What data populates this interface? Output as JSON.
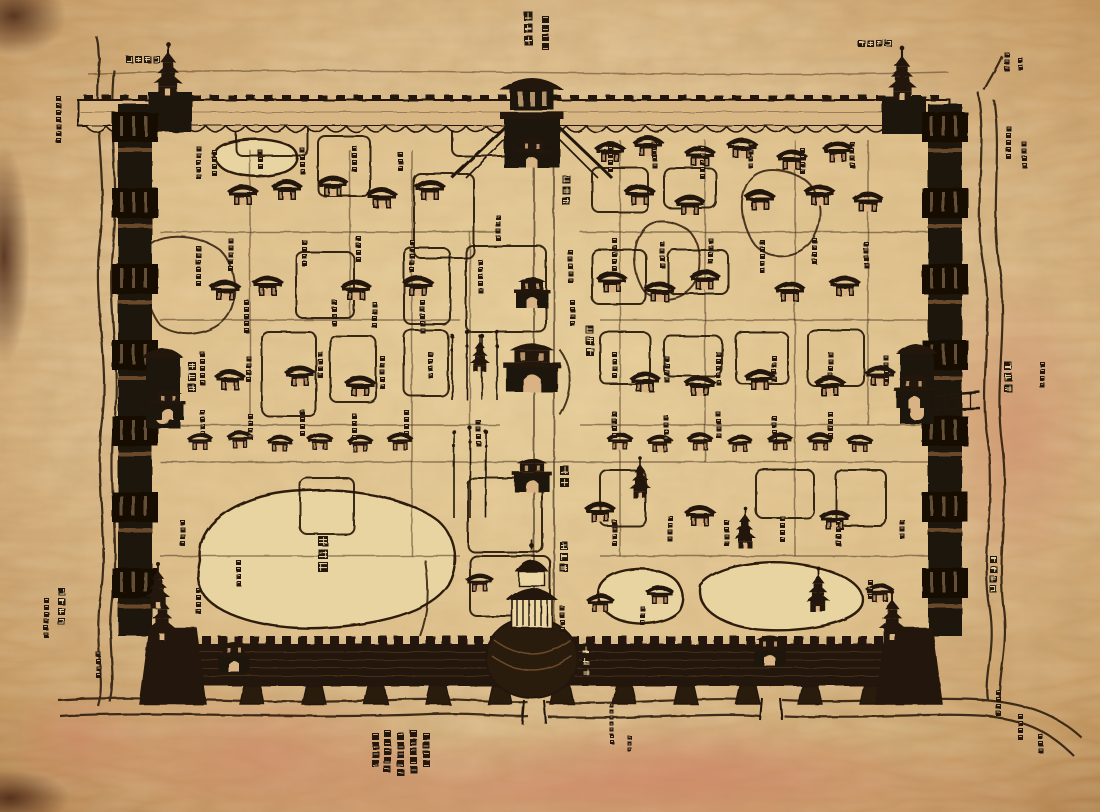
{
  "document": {
    "type": "antique Chinese walled-city map (woodblock style)",
    "script_note": "dense Chinese character labels, largely illegible at this resolution"
  },
  "palette": {
    "ink": "#241607",
    "wall_dark": "#1d1208",
    "paper": "#d9b383",
    "paper_light": "#ecd6a4",
    "ground": "#e3c791",
    "lake": "#e8d4a0",
    "stain_pink": "#cd8264",
    "hatch": "#6b4a2a"
  },
  "labels": [
    {
      "name": "north-gate-label",
      "text": "北安門",
      "x": 524,
      "y": 12,
      "dir": "v",
      "size": 9
    },
    {
      "name": "nw-corner-label",
      "text": "西北角樓",
      "x": 126,
      "y": 56,
      "dir": "h",
      "size": 7
    },
    {
      "name": "ne-corner-label",
      "text": "東北角樓",
      "x": 858,
      "y": 40,
      "dir": "h",
      "size": 7
    },
    {
      "name": "inner-north-gate-label",
      "text": "玄武門",
      "x": 562,
      "y": 175,
      "dir": "v",
      "size": 8
    },
    {
      "name": "central-hill-label",
      "text": "萬歲山",
      "x": 586,
      "y": 326,
      "dir": "v",
      "size": 8
    },
    {
      "name": "meridian-gate-label",
      "text": "午門",
      "x": 560,
      "y": 466,
      "dir": "v",
      "size": 9
    },
    {
      "name": "south-axis-gate-label",
      "text": "大明門",
      "x": 560,
      "y": 542,
      "dir": "v",
      "size": 8
    },
    {
      "name": "south-gate-label",
      "text": "正陽門",
      "x": 582,
      "y": 646,
      "dir": "v",
      "size": 8
    },
    {
      "name": "west-gate-label",
      "text": "西安門",
      "x": 188,
      "y": 362,
      "dir": "v",
      "size": 8
    },
    {
      "name": "east-gate-label",
      "text": "東安門",
      "x": 1004,
      "y": 362,
      "dir": "v",
      "size": 8
    },
    {
      "name": "west-lake-label",
      "text": "太液池",
      "x": 318,
      "y": 536,
      "dir": "v",
      "size": 10
    },
    {
      "name": "sw-corner-label",
      "text": "西南角樓",
      "x": 58,
      "y": 588,
      "dir": "v",
      "size": 7
    },
    {
      "name": "se-corner-label",
      "text": "東南角樓",
      "x": 990,
      "y": 556,
      "dir": "v",
      "size": 7
    }
  ],
  "annotation_blocks": [
    [
      56,
      96,
      7,
      5
    ],
    [
      44,
      598,
      6,
      5
    ],
    [
      96,
      652,
      4,
      5
    ],
    [
      1006,
      126,
      5,
      5
    ],
    [
      1022,
      142,
      4,
      5
    ],
    [
      1040,
      362,
      4,
      5
    ],
    [
      996,
      690,
      4,
      5
    ],
    [
      1018,
      714,
      4,
      5
    ],
    [
      1038,
      734,
      3,
      5
    ],
    [
      1004,
      52,
      3,
      5
    ],
    [
      1018,
      58,
      2,
      5
    ],
    [
      542,
      16,
      4,
      7
    ],
    [
      372,
      733,
      4,
      7
    ],
    [
      384,
      730,
      5,
      7
    ],
    [
      397,
      733,
      5,
      7
    ],
    [
      410,
      730,
      5,
      7
    ],
    [
      423,
      733,
      4,
      7
    ],
    [
      610,
      704,
      7,
      4
    ],
    [
      628,
      736,
      3,
      4
    ],
    [
      196,
      146,
      5,
      5
    ],
    [
      212,
      150,
      4,
      5
    ],
    [
      258,
      150,
      3,
      5
    ],
    [
      300,
      148,
      4,
      5
    ],
    [
      352,
      146,
      4,
      5
    ],
    [
      398,
      152,
      3,
      5
    ],
    [
      228,
      238,
      5,
      5
    ],
    [
      196,
      246,
      6,
      5
    ],
    [
      302,
      240,
      4,
      5
    ],
    [
      356,
      236,
      4,
      5
    ],
    [
      410,
      240,
      5,
      5
    ],
    [
      244,
      300,
      5,
      5
    ],
    [
      332,
      300,
      4,
      5
    ],
    [
      372,
      302,
      4,
      5
    ],
    [
      420,
      300,
      5,
      5
    ],
    [
      200,
      352,
      5,
      5
    ],
    [
      246,
      356,
      4,
      5
    ],
    [
      318,
      352,
      4,
      5
    ],
    [
      380,
      356,
      5,
      5
    ],
    [
      428,
      352,
      4,
      5
    ],
    [
      200,
      410,
      4,
      5
    ],
    [
      248,
      414,
      4,
      5
    ],
    [
      300,
      410,
      4,
      5
    ],
    [
      352,
      414,
      4,
      5
    ],
    [
      404,
      410,
      4,
      5
    ],
    [
      608,
      146,
      4,
      5
    ],
    [
      652,
      142,
      4,
      5
    ],
    [
      700,
      146,
      5,
      5
    ],
    [
      748,
      142,
      4,
      5
    ],
    [
      800,
      148,
      4,
      5
    ],
    [
      850,
      142,
      4,
      5
    ],
    [
      612,
      238,
      5,
      5
    ],
    [
      660,
      242,
      4,
      5
    ],
    [
      708,
      238,
      4,
      5
    ],
    [
      760,
      240,
      5,
      5
    ],
    [
      812,
      238,
      4,
      5
    ],
    [
      864,
      242,
      4,
      5
    ],
    [
      612,
      352,
      4,
      5
    ],
    [
      664,
      356,
      4,
      5
    ],
    [
      716,
      352,
      5,
      5
    ],
    [
      772,
      356,
      4,
      5
    ],
    [
      828,
      352,
      4,
      5
    ],
    [
      884,
      356,
      4,
      5
    ],
    [
      612,
      412,
      4,
      5
    ],
    [
      664,
      416,
      4,
      5
    ],
    [
      716,
      412,
      4,
      5
    ],
    [
      772,
      416,
      4,
      5
    ],
    [
      828,
      412,
      4,
      5
    ],
    [
      612,
      520,
      4,
      5
    ],
    [
      668,
      516,
      4,
      5
    ],
    [
      724,
      520,
      4,
      5
    ],
    [
      780,
      516,
      4,
      5
    ],
    [
      836,
      520,
      4,
      5
    ],
    [
      180,
      520,
      4,
      5
    ],
    [
      236,
      560,
      4,
      5
    ],
    [
      196,
      588,
      4,
      5
    ],
    [
      560,
      606,
      4,
      5
    ],
    [
      640,
      606,
      3,
      5
    ],
    [
      496,
      215,
      4,
      5
    ],
    [
      478,
      260,
      5,
      5
    ],
    [
      476,
      420,
      4,
      5
    ],
    [
      568,
      250,
      5,
      5
    ],
    [
      570,
      300,
      4,
      5
    ],
    [
      868,
      580,
      3,
      5
    ],
    [
      900,
      520,
      3,
      5
    ]
  ],
  "features": {
    "halls": [
      [
        243,
        205,
        1
      ],
      [
        287,
        200,
        1
      ],
      [
        333,
        196,
        1
      ],
      [
        382,
        208,
        1
      ],
      [
        430,
        200,
        1
      ],
      [
        610,
        162,
        1
      ],
      [
        648,
        156,
        1
      ],
      [
        700,
        166,
        1
      ],
      [
        742,
        158,
        1
      ],
      [
        792,
        170,
        1
      ],
      [
        838,
        162,
        1
      ],
      [
        640,
        205,
        1
      ],
      [
        690,
        215,
        1
      ],
      [
        760,
        210,
        1
      ],
      [
        820,
        205,
        1
      ],
      [
        868,
        212,
        1
      ],
      [
        225,
        300,
        1
      ],
      [
        268,
        296,
        1
      ],
      [
        356,
        300,
        1
      ],
      [
        418,
        296,
        1
      ],
      [
        612,
        292,
        1
      ],
      [
        660,
        302,
        1
      ],
      [
        705,
        290,
        1
      ],
      [
        790,
        302,
        1
      ],
      [
        845,
        296,
        1
      ],
      [
        230,
        390,
        1
      ],
      [
        300,
        386,
        1
      ],
      [
        360,
        396,
        1
      ],
      [
        645,
        392,
        1
      ],
      [
        700,
        396,
        1
      ],
      [
        760,
        390,
        1
      ],
      [
        830,
        396,
        1
      ],
      [
        880,
        386,
        1
      ],
      [
        200,
        450,
        0.85
      ],
      [
        240,
        448,
        0.85
      ],
      [
        280,
        452,
        0.85
      ],
      [
        320,
        450,
        0.85
      ],
      [
        360,
        452,
        0.85
      ],
      [
        400,
        450,
        0.85
      ],
      [
        620,
        450,
        0.85
      ],
      [
        660,
        452,
        0.85
      ],
      [
        700,
        450,
        0.85
      ],
      [
        740,
        452,
        0.85
      ],
      [
        780,
        450,
        0.85
      ],
      [
        820,
        450,
        0.85
      ],
      [
        860,
        452,
        0.85
      ],
      [
        600,
        522,
        1
      ],
      [
        700,
        526,
        1
      ],
      [
        835,
        530,
        1
      ],
      [
        600,
        612,
        0.9
      ],
      [
        660,
        604,
        0.9
      ],
      [
        880,
        602,
        0.9
      ],
      [
        480,
        592,
        0.9
      ]
    ],
    "pagodas": [
      [
        168,
        96,
        1.3
      ],
      [
        902,
        100,
        1.3
      ],
      [
        162,
        640,
        1.2
      ],
      [
        892,
        640,
        1.2
      ],
      [
        158,
        608,
        1.1
      ],
      [
        818,
        612,
        1.1
      ],
      [
        640,
        498,
        1
      ],
      [
        745,
        548,
        1
      ],
      [
        480,
        372,
        0.9
      ]
    ],
    "gatehouses": [
      [
        532,
        168,
        1
      ],
      [
        532,
        308,
        1
      ],
      [
        532,
        392,
        1.6
      ],
      [
        532,
        492,
        1.1
      ],
      [
        168,
        420,
        1
      ],
      [
        914,
        408,
        1.1
      ],
      [
        234,
        672,
        1
      ],
      [
        770,
        666,
        1
      ]
    ],
    "flagpoles": [
      [
        452,
        336,
        400
      ],
      [
        467,
        332,
        400
      ],
      [
        482,
        336,
        400
      ],
      [
        497,
        332,
        400
      ],
      [
        454,
        432,
        518
      ],
      [
        470,
        428,
        518
      ],
      [
        486,
        432,
        518
      ]
    ],
    "compounds": [
      [
        236,
        118,
        72,
        38
      ],
      [
        318,
        136,
        52,
        60
      ],
      [
        414,
        174,
        60,
        84
      ],
      [
        452,
        112,
        86,
        44
      ],
      [
        592,
        168,
        56,
        44
      ],
      [
        664,
        168,
        52,
        40
      ],
      [
        296,
        252,
        58,
        66
      ],
      [
        404,
        248,
        46,
        76
      ],
      [
        466,
        246,
        80,
        86
      ],
      [
        592,
        250,
        54,
        54
      ],
      [
        668,
        250,
        60,
        44
      ],
      [
        262,
        332,
        54,
        84
      ],
      [
        330,
        336,
        46,
        66
      ],
      [
        404,
        330,
        44,
        66
      ],
      [
        600,
        332,
        50,
        52
      ],
      [
        664,
        336,
        58,
        40
      ],
      [
        736,
        332,
        52,
        52
      ],
      [
        808,
        330,
        56,
        56
      ],
      [
        300,
        478,
        54,
        56
      ],
      [
        468,
        478,
        74,
        74
      ],
      [
        600,
        470,
        46,
        56
      ],
      [
        756,
        470,
        58,
        48
      ],
      [
        836,
        470,
        50,
        56
      ],
      [
        470,
        556,
        80,
        60
      ]
    ],
    "streets": [
      [
        160,
        232,
        500,
        232
      ],
      [
        580,
        232,
        928,
        232
      ],
      [
        160,
        320,
        460,
        320
      ],
      [
        600,
        320,
        928,
        320
      ],
      [
        160,
        425,
        500,
        425
      ],
      [
        580,
        425,
        928,
        425
      ],
      [
        160,
        462,
        928,
        462
      ],
      [
        160,
        556,
        460,
        556
      ],
      [
        600,
        556,
        928,
        556
      ],
      [
        250,
        150,
        250,
        425
      ],
      [
        350,
        150,
        350,
        320
      ],
      [
        412,
        150,
        412,
        556
      ],
      [
        470,
        232,
        470,
        425
      ],
      [
        620,
        140,
        620,
        556
      ],
      [
        705,
        140,
        705,
        462
      ],
      [
        795,
        140,
        795,
        556
      ],
      [
        868,
        140,
        868,
        425
      ]
    ]
  }
}
